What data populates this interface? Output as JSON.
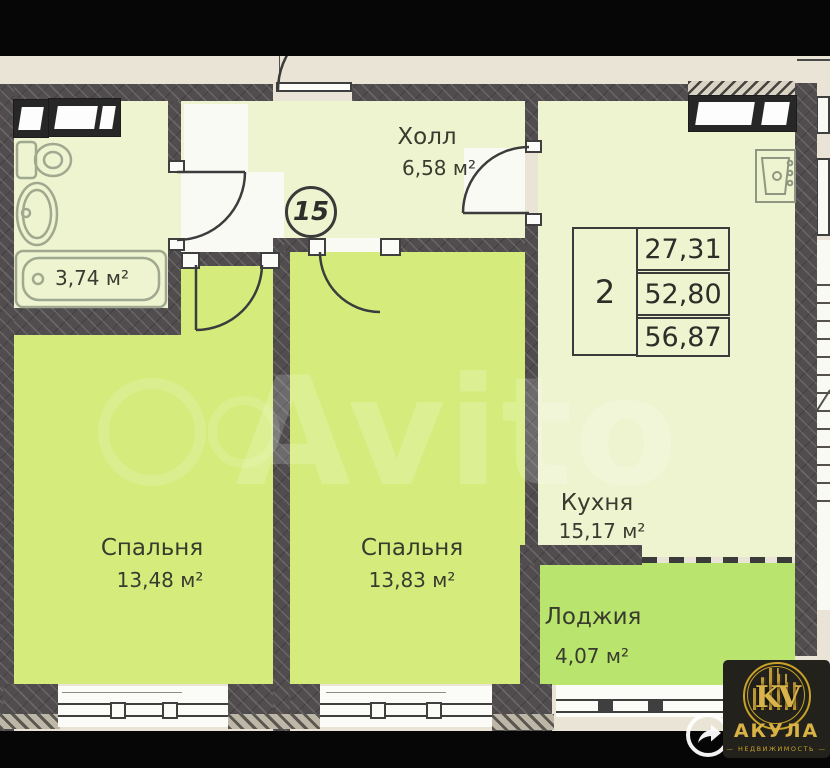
{
  "plan": {
    "unit_number": "15",
    "watermark": "Avito",
    "rooms": [
      {
        "id": "hall",
        "name": "Холл",
        "area": "6,58 м²"
      },
      {
        "id": "bathroom",
        "name": "",
        "area": "3,74 м²"
      },
      {
        "id": "bedroom-1",
        "name": "Спальня",
        "area": "13,48 м²"
      },
      {
        "id": "bedroom-2",
        "name": "Спальня",
        "area": "13,83 м²"
      },
      {
        "id": "kitchen",
        "name": "Кухня",
        "area": "15,17 м²"
      },
      {
        "id": "loggia",
        "name": "Лоджия",
        "area": "4,07 м²"
      }
    ],
    "info_table": {
      "rooms_count": "2",
      "values": [
        "27,31",
        "52,80",
        "56,87"
      ]
    }
  },
  "branding": {
    "logo_monogram": "KV",
    "logo_title": "АКУЛА",
    "logo_subtitle": "— НЕДВИЖИМОСТЬ —"
  },
  "icons": {
    "share": "curved-share-arrow",
    "logo_mark": "gold-building-skyline-in-ring"
  },
  "colors": {
    "wall": "#514d4f",
    "room_pale": "#eef4d0",
    "room_bright": "#d5ec7c",
    "room_loggia": "#b9e56e",
    "background_beige": "#e9e4d6",
    "line": "#3b3b3b",
    "fixture": "#a0a890",
    "white_zone": "#fafaf5",
    "bar_black": "#060606",
    "logo_gold": "#c9a227",
    "logo_bg": "#23211c"
  }
}
